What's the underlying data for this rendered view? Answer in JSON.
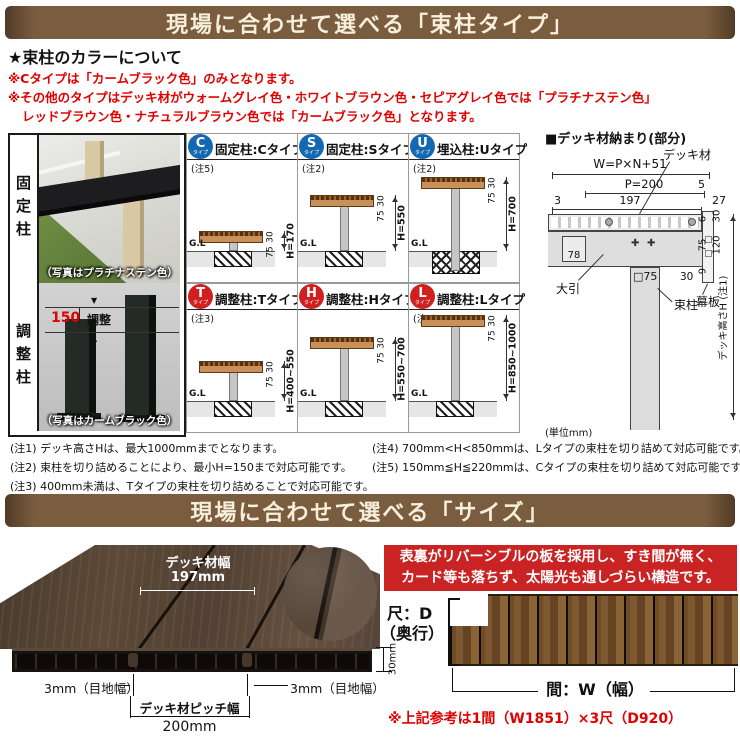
{
  "colors": {
    "banner_bg": "#7a5c3e",
    "banner_text": "#f7efdb",
    "note_red": "#e00000",
    "badge_blue": "#1468b2",
    "badge_red": "#cf1f1f",
    "feature_box_red": "#c92323",
    "deck_wood": "#c9905a"
  },
  "banners": {
    "type_title": "現場に合わせて選べる「束柱タイプ」",
    "size_title": "現場に合わせて選べる「サイズ」"
  },
  "color_section": {
    "heading": "★束柱のカラーについて",
    "note1": "※Cタイプは「カームブラック色」のみとなります。",
    "note2": "※その他のタイプはデッキ材がウォームグレイ色・ホワイトブラウン色・セピアグレイ色では「プラチナステン色」",
    "note3": "レッドブラウン色・ナチュラルブラウン色では「カームブラック色」となります。"
  },
  "photo_panel": {
    "fixed_label": "固定柱",
    "fixed_caption": "（写真はプラチナステン色）",
    "adjust_label": "調整柱",
    "adjust_caption": "（写真はカームブラック色）",
    "adjust_dim": "150",
    "adjust_dim_label": "調整"
  },
  "type_cells": [
    {
      "badge": "C",
      "badge_sub": "タイプ",
      "title": "固定柱:Cタイプ",
      "note": "(注5)",
      "gl": "G.L",
      "dim_deck": "30",
      "dim_sub": "75",
      "dim_h": "H=170"
    },
    {
      "badge": "S",
      "badge_sub": "タイプ",
      "title": "固定柱:Sタイプ",
      "note": "(注2)",
      "gl": "G.L",
      "dim_deck": "30",
      "dim_sub": "75",
      "dim_h": "H=550"
    },
    {
      "badge": "U",
      "badge_sub": "タイプ",
      "title": "埋込柱:Uタイプ",
      "note": "(注2)",
      "gl": "G.L",
      "dim_deck": "30",
      "dim_sub": "75",
      "dim_h": "H=700"
    },
    {
      "badge": "T",
      "badge_sub": "タイプ",
      "title": "調整柱:Tタイプ",
      "note": "(注3)",
      "gl": "G.L",
      "dim_deck": "30",
      "dim_sub": "75",
      "dim_h": "H=400~550"
    },
    {
      "badge": "H",
      "badge_sub": "タイプ",
      "title": "調整柱:Hタイプ",
      "note": "",
      "gl": "G.L",
      "dim_deck": "30",
      "dim_sub": "75",
      "dim_h": "H=550~700"
    },
    {
      "badge": "L",
      "badge_sub": "タイプ",
      "title": "調整柱:Lタイプ",
      "note": "(注4)",
      "gl": "G.L",
      "dim_deck": "30",
      "dim_sub": "75",
      "dim_h": "H=850~1000"
    }
  ],
  "detail_diagram": {
    "title": "■デッキ材納まり(部分)",
    "deck_label": "デッキ材",
    "w_formula": "W=P×N+51",
    "p_dim": "P=200",
    "dim_5": "5",
    "dim_3": "3",
    "dim_197": "197",
    "dim_27": "27",
    "dim_6": "6",
    "dim_30_top": "30",
    "dim_75": "75",
    "dim_120": "120",
    "dim_30_bottom": "30",
    "dim_9": "9",
    "dim_78": "78",
    "girder_label": "大引",
    "post_section": "□75",
    "post_label": "束柱",
    "fascia_label": "幕板",
    "height_label": "デッキ高さH (注1)",
    "unit": "(単位mm)"
  },
  "notes": {
    "n1": "(注1) デッキ高さHは、最大1000mmまでとなります。",
    "n2": "(注2) 束柱を切り詰めることにより、最小H=150まで対応可能です。",
    "n3": "(注3) 400mm未満は、Tタイプの束柱を切り詰めることで対応可能です。",
    "n4": "(注4) 700mm<H<850mmは、Lタイプの束柱を切り詰めて対応可能です。",
    "n5": "(注5) 150mm≦H≦220mmは、Cタイプの束柱を切り詰めて対応可能です。"
  },
  "size_section": {
    "deck_width_label": "デッキ材幅",
    "deck_width_value": "197mm",
    "joint_left": "3mm（目地幅）",
    "joint_right": "3mm（目地幅）",
    "pitch_label": "デッキ材ピッチ幅",
    "pitch_value": "200mm",
    "thickness": "30mm",
    "feature_line1": "表裏がリバーシブルの板を採用し、すき間が無く、",
    "feature_line2": "カード等も落ちず、太陽光も通しづらい構造です。",
    "depth_label_1": "尺：D",
    "depth_label_2": "（奥行）",
    "width_label": "間：W（幅）",
    "reference": "※上記参考は1間（W1851）×3尺（D920）"
  }
}
